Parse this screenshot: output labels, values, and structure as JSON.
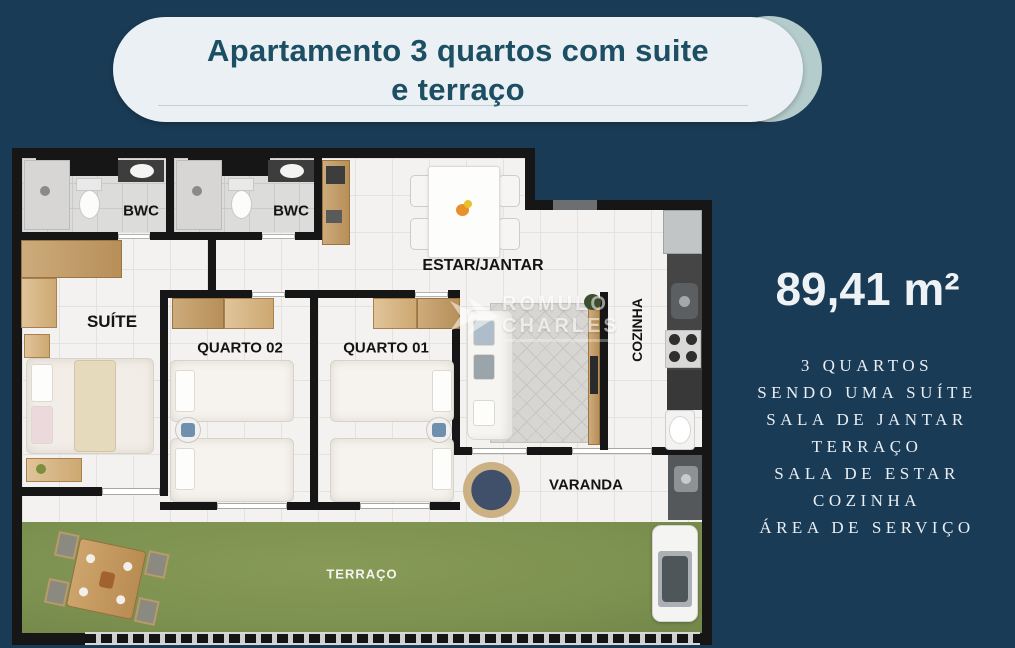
{
  "banner": {
    "line1": "Apartamento 3 quartos com suite",
    "line2": "e terraço"
  },
  "info": {
    "area": "89,41 m²",
    "features": [
      "3 QUARTOS",
      "SENDO UMA SUÍTE",
      "SALA DE JANTAR",
      "TERRAÇO",
      "SALA DE ESTAR",
      "COZINHA",
      "ÁREA DE SERVIÇO"
    ]
  },
  "plan": {
    "labels": {
      "bwc1": "BWC",
      "bwc2": "BWC",
      "suite": "SUÍTE",
      "quarto02": "QUARTO 02",
      "quarto01": "QUARTO 01",
      "estar_jantar": "ESTAR/JANTAR",
      "cozinha": "COZINHA",
      "varanda": "VARANDA",
      "terraco": "TERRAÇO"
    }
  },
  "watermark": {
    "line1": "ROMULO",
    "line2": "CHARLES"
  },
  "colors": {
    "background": "#1a3b55",
    "banner_bg": "#eaf0f3",
    "banner_accent": "#b5cccd",
    "banner_text": "#1c4f63",
    "wall": "#161616",
    "grass": "#7e9251",
    "text_light": "#eef2f5"
  }
}
